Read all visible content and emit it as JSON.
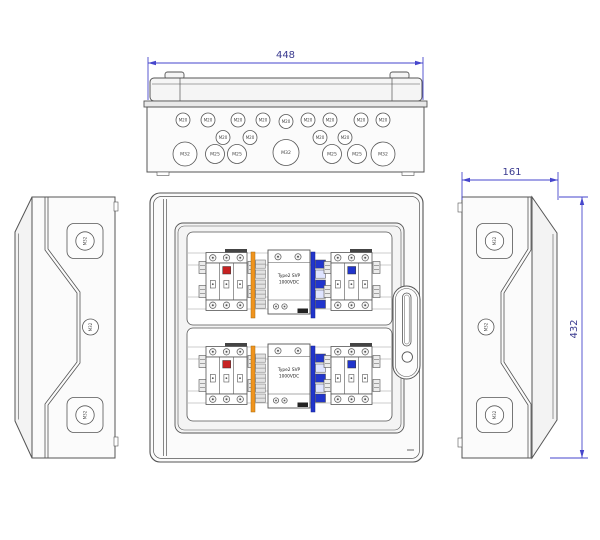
{
  "drawing": {
    "line_color": "#555555",
    "dim_line_color": "#4646cc",
    "dim_text_color": "#3a3a8f",
    "indicator_red": "#c62222",
    "indicator_blue": "#2135cc",
    "terminal_orange": "#f0941e"
  },
  "dimensions": {
    "width": "448",
    "depth": "161",
    "height": "432"
  },
  "top_view": {
    "row1": [
      "M20",
      "M20",
      "M20",
      "M20",
      "M20",
      "M20",
      "M20",
      "M20",
      "M20"
    ],
    "row2": [
      "M20",
      "M20",
      "M20",
      "M20"
    ],
    "row3": [
      "M32",
      "M25",
      "M25",
      "M32",
      "M25",
      "M25",
      "M32"
    ]
  },
  "left_view": {
    "knockouts": [
      "M32",
      "M32",
      "M32"
    ]
  },
  "right_view": {
    "knockouts": [
      "M32",
      "M32",
      "M32"
    ]
  },
  "front_view": {
    "rows": [
      {
        "spd_line1": "Type2 SVP",
        "spd_line2": "1000VDC"
      },
      {
        "spd_line1": "Type2 SVP",
        "spd_line2": "1000VDC"
      }
    ]
  }
}
